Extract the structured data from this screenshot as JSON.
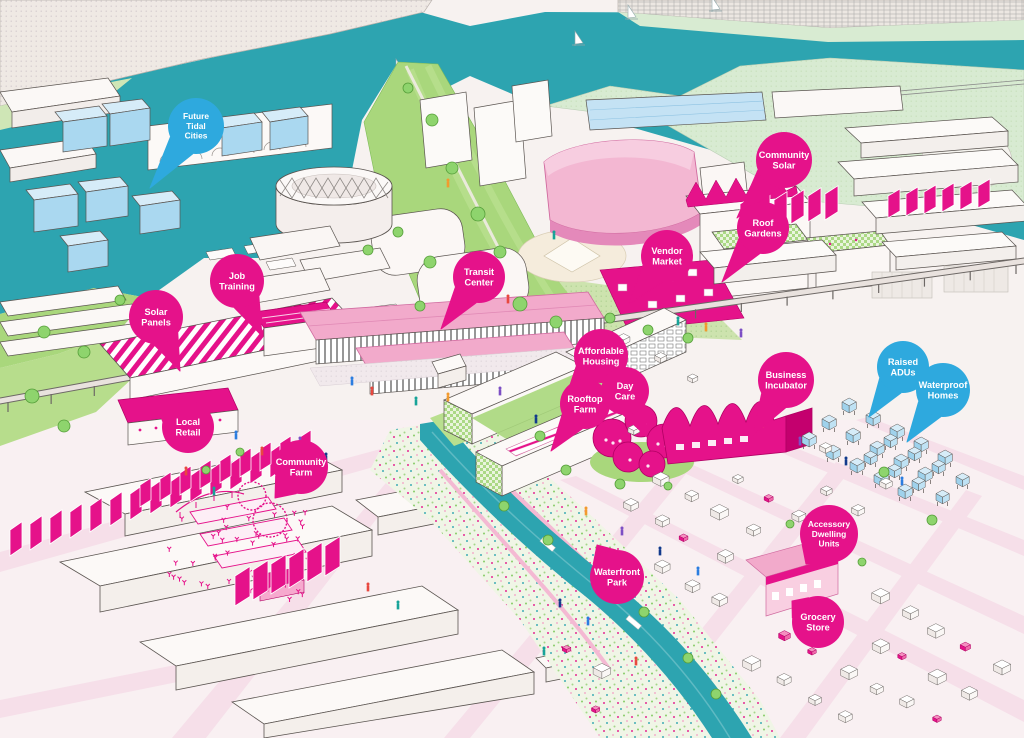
{
  "palette": {
    "magenta_accent": "#e5128a",
    "magenta_dark": "#b00063",
    "pink_mid": "#f2aacb",
    "pink_light": "#f7cfe0",
    "blue_bubble": "#2ea9de",
    "blue_light": "#b8ddf1",
    "water_teal": "#2da4b0",
    "lawn_green": "#a9d77c",
    "pale_green": "#d8ebd2",
    "tree_green": "#8ed46d",
    "street_pink": "#f6dfe9",
    "paper": "#f7f2f0"
  },
  "callouts": [
    {
      "id": "future-tidal-cities",
      "lines": [
        "Future",
        "Tidal",
        "Cities"
      ],
      "color_key": "blue",
      "cx": 196,
      "cy": 126,
      "r": 28,
      "tip": [
        150,
        188
      ]
    },
    {
      "id": "community-solar",
      "lines": [
        "Community",
        "Solar"
      ],
      "color_key": "pink",
      "cx": 784,
      "cy": 160,
      "r": 28,
      "tip": [
        737,
        218
      ]
    },
    {
      "id": "roof-gardens",
      "lines": [
        "Roof",
        "Gardens"
      ],
      "color_key": "pink",
      "cx": 763,
      "cy": 228,
      "r": 26,
      "tip": [
        722,
        282
      ]
    },
    {
      "id": "vendor-market",
      "lines": [
        "Vendor",
        "Market"
      ],
      "color_key": "pink",
      "cx": 667,
      "cy": 256,
      "r": 26,
      "tip": [
        628,
        305
      ]
    },
    {
      "id": "job-training",
      "lines": [
        "Job",
        "Training"
      ],
      "color_key": "pink",
      "cx": 237,
      "cy": 281,
      "r": 27,
      "tip": [
        262,
        336
      ]
    },
    {
      "id": "transit-center",
      "lines": [
        "Transit",
        "Center"
      ],
      "color_key": "pink",
      "cx": 479,
      "cy": 277,
      "r": 26,
      "tip": [
        441,
        329
      ]
    },
    {
      "id": "solar-panels",
      "lines": [
        "Solar",
        "Panels"
      ],
      "color_key": "pink",
      "cx": 156,
      "cy": 317,
      "r": 27,
      "tip": [
        180,
        371
      ]
    },
    {
      "id": "affordable-housing",
      "lines": [
        "Affordable",
        "Housing"
      ],
      "color_key": "pink",
      "cx": 601,
      "cy": 356,
      "r": 27,
      "tip": [
        563,
        406
      ]
    },
    {
      "id": "rooftop-farm",
      "lines": [
        "Rooftop",
        "Farm"
      ],
      "color_key": "pink",
      "cx": 585,
      "cy": 404,
      "r": 25,
      "tip": [
        551,
        451
      ]
    },
    {
      "id": "day-care",
      "lines": [
        "Day",
        "Care"
      ],
      "color_key": "pink",
      "cx": 625,
      "cy": 391,
      "r": 24,
      "tip": [
        647,
        437
      ]
    },
    {
      "id": "business-incubator",
      "lines": [
        "Business",
        "Incubator"
      ],
      "color_key": "pink",
      "cx": 786,
      "cy": 380,
      "r": 28,
      "tip": [
        753,
        435
      ]
    },
    {
      "id": "raised-adus",
      "lines": [
        "Raised",
        "ADUs"
      ],
      "color_key": "blue",
      "cx": 903,
      "cy": 367,
      "r": 26,
      "tip": [
        869,
        417
      ]
    },
    {
      "id": "waterproof-homes",
      "lines": [
        "Waterproof",
        "Homes"
      ],
      "color_key": "blue",
      "cx": 943,
      "cy": 390,
      "r": 27,
      "tip": [
        907,
        442
      ]
    },
    {
      "id": "local-retail",
      "lines": [
        "Local",
        "Retail"
      ],
      "color_key": "pink",
      "cx": 188,
      "cy": 427,
      "r": 26,
      "tip": [
        154,
        396
      ]
    },
    {
      "id": "community-farm",
      "lines": [
        "Community",
        "Farm"
      ],
      "color_key": "pink",
      "cx": 301,
      "cy": 467,
      "r": 27,
      "tip": [
        275,
        498
      ]
    },
    {
      "id": "accessory-dwelling-units",
      "lines": [
        "Accessory",
        "Dwelling",
        "Units"
      ],
      "color_key": "pink",
      "cx": 829,
      "cy": 534,
      "r": 29,
      "tip": [
        806,
        564
      ]
    },
    {
      "id": "waterfront-park",
      "lines": [
        "Waterfront",
        "Park"
      ],
      "color_key": "pink",
      "cx": 617,
      "cy": 577,
      "r": 27,
      "tip": [
        597,
        545
      ]
    },
    {
      "id": "grocery-store",
      "lines": [
        "Grocery",
        "Store"
      ],
      "color_key": "pink",
      "cx": 818,
      "cy": 622,
      "r": 26,
      "tip": [
        792,
        601
      ]
    }
  ]
}
